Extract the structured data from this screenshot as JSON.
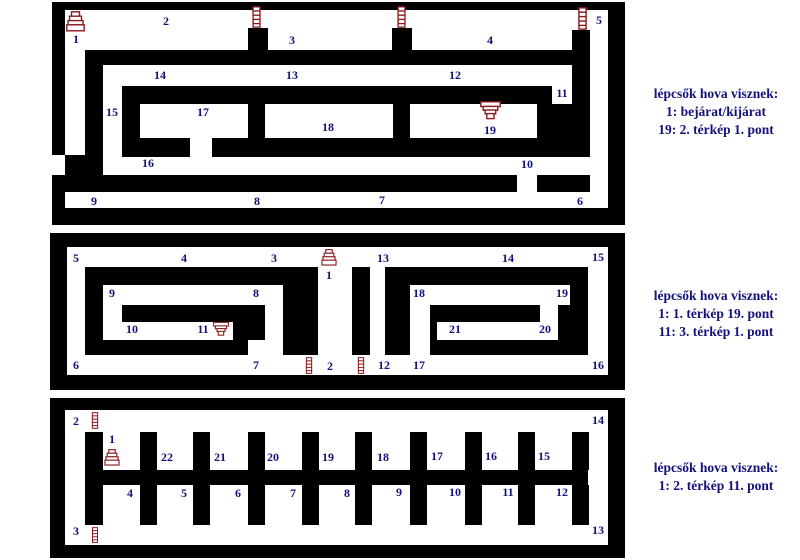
{
  "palette": {
    "wall": "#000000",
    "label": "#12127a",
    "icon": "#8b1a1a",
    "bg": "#ffffff"
  },
  "legends": [
    {
      "x": 716,
      "y": 85,
      "lines": [
        "lépcsők hova visznek:",
        "1: bejárat/kijárat",
        "19: 2. térkép 1. pont"
      ]
    },
    {
      "x": 716,
      "y": 287,
      "lines": [
        "lépcsők hova visznek:",
        "1: 1. térkép 19. pont",
        "11: 3. térkép 1. pont"
      ]
    },
    {
      "x": 716,
      "y": 459,
      "lines": [
        "lépcsők hova visznek:",
        "1: 2. térkép 11. pont"
      ]
    }
  ],
  "panels": [
    {
      "name": "map-1",
      "frame": [
        52,
        2,
        573,
        223
      ],
      "interior": [
        65,
        10,
        543,
        198
      ],
      "walls": [
        [
          85,
          50,
          487,
          15
        ],
        [
          572,
          30,
          18,
          127
        ],
        [
          248,
          28,
          20,
          22
        ],
        [
          392,
          28,
          20,
          22
        ],
        [
          85,
          50,
          18,
          107
        ],
        [
          65,
          155,
          38,
          37
        ],
        [
          122,
          86,
          430,
          18
        ],
        [
          122,
          104,
          18,
          34
        ],
        [
          248,
          104,
          17,
          34
        ],
        [
          393,
          104,
          17,
          34
        ],
        [
          537,
          104,
          35,
          53
        ],
        [
          122,
          138,
          68,
          19
        ],
        [
          212,
          138,
          360,
          19
        ],
        [
          102,
          175,
          415,
          17
        ],
        [
          537,
          175,
          53,
          17
        ]
      ],
      "white_patches": [
        [
          52,
          155,
          13,
          20
        ]
      ],
      "icons": [
        {
          "type": "stairs-up",
          "x": 66,
          "y": 11,
          "w": 19,
          "h": 21
        },
        {
          "type": "ladder",
          "x": 252,
          "y": 6,
          "w": 9,
          "h": 22
        },
        {
          "type": "ladder",
          "x": 397,
          "y": 6,
          "w": 9,
          "h": 22
        },
        {
          "type": "ladder",
          "x": 578,
          "y": 7,
          "w": 9,
          "h": 23
        },
        {
          "type": "stairs-down",
          "x": 480,
          "y": 101,
          "w": 21,
          "h": 19
        }
      ],
      "labels": [
        {
          "t": "1",
          "x": 76,
          "y": 39
        },
        {
          "t": "2",
          "x": 166,
          "y": 21
        },
        {
          "t": "3",
          "x": 292,
          "y": 40
        },
        {
          "t": "4",
          "x": 490,
          "y": 40
        },
        {
          "t": "5",
          "x": 599,
          "y": 20
        },
        {
          "t": "6",
          "x": 580,
          "y": 201
        },
        {
          "t": "7",
          "x": 382,
          "y": 200
        },
        {
          "t": "8",
          "x": 257,
          "y": 201
        },
        {
          "t": "9",
          "x": 94,
          "y": 201
        },
        {
          "t": "10",
          "x": 527,
          "y": 164
        },
        {
          "t": "11",
          "x": 562,
          "y": 93
        },
        {
          "t": "12",
          "x": 455,
          "y": 75
        },
        {
          "t": "13",
          "x": 292,
          "y": 75
        },
        {
          "t": "14",
          "x": 160,
          "y": 75
        },
        {
          "t": "15",
          "x": 112,
          "y": 112
        },
        {
          "t": "16",
          "x": 148,
          "y": 163
        },
        {
          "t": "17",
          "x": 203,
          "y": 112
        },
        {
          "t": "18",
          "x": 328,
          "y": 127
        },
        {
          "t": "19",
          "x": 490,
          "y": 130
        }
      ]
    },
    {
      "name": "map-2",
      "frame": [
        50,
        233,
        575,
        157
      ],
      "interior": [
        67,
        247,
        541,
        128
      ],
      "walls": [
        [
          85,
          267,
          198,
          18
        ],
        [
          85,
          285,
          18,
          70
        ],
        [
          122,
          305,
          143,
          17
        ],
        [
          233,
          322,
          32,
          18
        ],
        [
          85,
          340,
          163,
          15
        ],
        [
          283,
          267,
          19,
          88
        ],
        [
          302,
          267,
          16,
          88
        ],
        [
          352,
          267,
          18,
          88
        ],
        [
          385,
          267,
          203,
          18
        ],
        [
          385,
          285,
          25,
          70
        ],
        [
          570,
          285,
          18,
          70
        ],
        [
          430,
          340,
          140,
          15
        ],
        [
          430,
          305,
          110,
          17
        ],
        [
          430,
          322,
          7,
          18
        ],
        [
          558,
          305,
          12,
          35
        ]
      ],
      "white_patches": [],
      "icons": [
        {
          "type": "stairs-up",
          "x": 320,
          "y": 249,
          "w": 18,
          "h": 17
        },
        {
          "type": "stairs-down",
          "x": 213,
          "y": 321,
          "w": 16,
          "h": 16
        },
        {
          "type": "ladder",
          "x": 305,
          "y": 357,
          "w": 8,
          "h": 17
        },
        {
          "type": "ladder",
          "x": 357,
          "y": 357,
          "w": 8,
          "h": 17
        }
      ],
      "labels": [
        {
          "t": "5",
          "x": 76,
          "y": 258
        },
        {
          "t": "4",
          "x": 184,
          "y": 258
        },
        {
          "t": "3",
          "x": 274,
          "y": 258
        },
        {
          "t": "1",
          "x": 329,
          "y": 275
        },
        {
          "t": "13",
          "x": 383,
          "y": 258
        },
        {
          "t": "14",
          "x": 508,
          "y": 258
        },
        {
          "t": "15",
          "x": 598,
          "y": 257
        },
        {
          "t": "9",
          "x": 112,
          "y": 293
        },
        {
          "t": "8",
          "x": 256,
          "y": 293
        },
        {
          "t": "18",
          "x": 419,
          "y": 293
        },
        {
          "t": "19",
          "x": 562,
          "y": 293
        },
        {
          "t": "10",
          "x": 132,
          "y": 329
        },
        {
          "t": "11",
          "x": 203,
          "y": 329
        },
        {
          "t": "21",
          "x": 455,
          "y": 329
        },
        {
          "t": "20",
          "x": 545,
          "y": 329
        },
        {
          "t": "6",
          "x": 76,
          "y": 365
        },
        {
          "t": "7",
          "x": 256,
          "y": 365
        },
        {
          "t": "2",
          "x": 330,
          "y": 366
        },
        {
          "t": "12",
          "x": 384,
          "y": 365
        },
        {
          "t": "17",
          "x": 419,
          "y": 365
        },
        {
          "t": "16",
          "x": 598,
          "y": 365
        }
      ]
    },
    {
      "name": "map-3",
      "frame": [
        50,
        398,
        575,
        160
      ],
      "interior": [
        65,
        410,
        543,
        135
      ],
      "walls": [
        [
          85,
          432,
          18,
          93
        ],
        [
          85,
          470,
          503,
          15
        ],
        [
          140,
          432,
          17,
          38
        ],
        [
          193,
          432,
          17,
          38
        ],
        [
          248,
          432,
          17,
          38
        ],
        [
          302,
          432,
          17,
          38
        ],
        [
          355,
          432,
          17,
          38
        ],
        [
          410,
          432,
          17,
          38
        ],
        [
          465,
          432,
          17,
          38
        ],
        [
          518,
          432,
          17,
          38
        ],
        [
          572,
          432,
          17,
          38
        ],
        [
          140,
          485,
          17,
          40
        ],
        [
          193,
          485,
          17,
          40
        ],
        [
          248,
          485,
          17,
          40
        ],
        [
          302,
          485,
          17,
          40
        ],
        [
          355,
          485,
          17,
          40
        ],
        [
          410,
          485,
          17,
          40
        ],
        [
          465,
          485,
          17,
          40
        ],
        [
          518,
          485,
          17,
          40
        ],
        [
          572,
          485,
          17,
          40
        ]
      ],
      "white_patches": [],
      "icons": [
        {
          "type": "ladder",
          "x": 91,
          "y": 412,
          "w": 8,
          "h": 17
        },
        {
          "type": "stairs-up",
          "x": 103,
          "y": 449,
          "w": 18,
          "h": 17
        },
        {
          "type": "ladder",
          "x": 91,
          "y": 527,
          "w": 8,
          "h": 16
        }
      ],
      "labels": [
        {
          "t": "2",
          "x": 76,
          "y": 421
        },
        {
          "t": "14",
          "x": 598,
          "y": 420
        },
        {
          "t": "1",
          "x": 112,
          "y": 439
        },
        {
          "t": "22",
          "x": 167,
          "y": 457
        },
        {
          "t": "21",
          "x": 220,
          "y": 457
        },
        {
          "t": "20",
          "x": 273,
          "y": 457
        },
        {
          "t": "19",
          "x": 328,
          "y": 457
        },
        {
          "t": "18",
          "x": 383,
          "y": 457
        },
        {
          "t": "17",
          "x": 437,
          "y": 456
        },
        {
          "t": "16",
          "x": 491,
          "y": 456
        },
        {
          "t": "15",
          "x": 544,
          "y": 456
        },
        {
          "t": "4",
          "x": 130,
          "y": 493
        },
        {
          "t": "5",
          "x": 184,
          "y": 493
        },
        {
          "t": "6",
          "x": 238,
          "y": 493
        },
        {
          "t": "7",
          "x": 293,
          "y": 493
        },
        {
          "t": "8",
          "x": 347,
          "y": 493
        },
        {
          "t": "9",
          "x": 399,
          "y": 492
        },
        {
          "t": "10",
          "x": 455,
          "y": 492
        },
        {
          "t": "11",
          "x": 508,
          "y": 492
        },
        {
          "t": "12",
          "x": 562,
          "y": 492
        },
        {
          "t": "3",
          "x": 76,
          "y": 531
        },
        {
          "t": "13",
          "x": 598,
          "y": 530
        }
      ]
    }
  ]
}
